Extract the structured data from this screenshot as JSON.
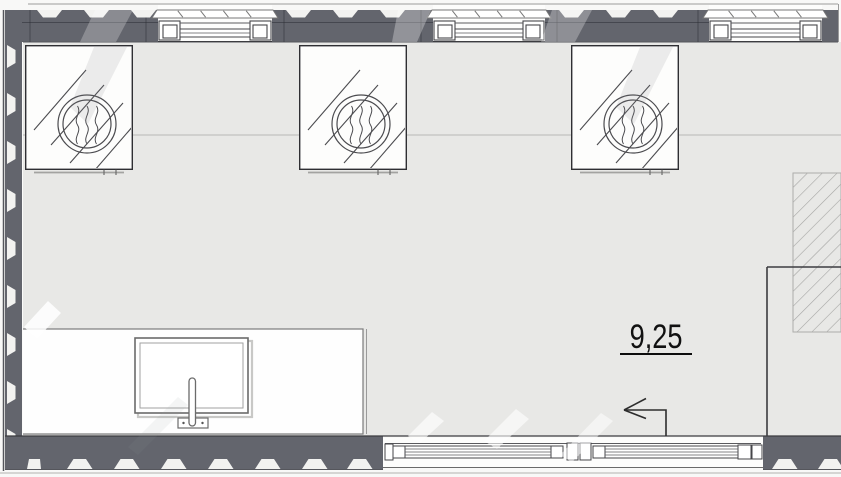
{
  "room": {
    "area_label": "9,25"
  },
  "entrance_arrow": {
    "icon": "left-arrow-icon",
    "direction": "left"
  },
  "fixtures": {
    "heating_units": {
      "icon": "fan-coil-icon",
      "count": 3
    },
    "sink": {
      "icon": "sink-icon"
    },
    "faucet": {
      "icon": "faucet-icon"
    },
    "shaft": {
      "icon": "diagonal-hatch-area"
    }
  },
  "openings": {
    "top_windows": 3,
    "bottom_window_panels": 2
  },
  "colors": {
    "wall": "#63656d",
    "wall_notch": "#f2f2f0",
    "floor": "#e8e8e6",
    "line_dark": "#3c3c40",
    "line_light": "#b7b7b5",
    "hatch_line": "#a5a5a3",
    "paper": "#f8f8f7",
    "label_text": "#111111"
  }
}
